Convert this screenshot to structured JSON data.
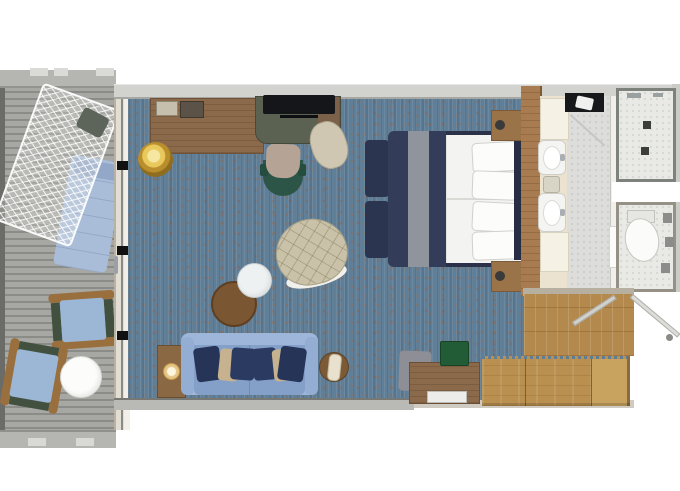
{
  "meta": {
    "type": "floor-plan",
    "subject": "cruise-ship balcony suite stateroom, top-down 3D floor plan",
    "width_px": 680,
    "height_px": 491
  },
  "palette": {
    "carpet_blue": "#5f7e97",
    "carpet_speckle_rust": "#96644082",
    "deck_gray": "#9d9d99",
    "oak_wood": "#b3894d",
    "walnut_wood": "#8b6a4b",
    "sofa_blue": "#84a0c9",
    "pillow_navy": "#263457",
    "pillow_tan": "#c6b28e",
    "bed_runner_navy": "#333c58",
    "bed_runner_gray": "#8f949d",
    "bed_frame_navy": "#2a3148",
    "gold_pouf": "#d8ac3f",
    "desk_chair_green": "#2d5547",
    "armchair_beige": "#c9c2a8",
    "bathroom_tile": "#dddddb",
    "vanity_cream": "#ebe3cf",
    "bath_mat_black": "#17181a",
    "lounger_blue": "#a9bdd9",
    "wall_gray": "#d2d2ce",
    "white": "#ffffff"
  },
  "rooms": [
    {
      "id": "balcony",
      "label": "Balcony"
    },
    {
      "id": "living-area",
      "label": "Living Area"
    },
    {
      "id": "bedroom",
      "label": "Bedroom"
    },
    {
      "id": "bathroom",
      "label": "Bathroom"
    },
    {
      "id": "shower-room",
      "label": "Shower Room"
    },
    {
      "id": "toilet-room",
      "label": "Toilet Room"
    },
    {
      "id": "entry-hall",
      "label": "Entry Hall"
    },
    {
      "id": "wardrobe",
      "label": "Wardrobe"
    }
  ],
  "furniture": {
    "balcony": [
      "Hammock lounger with net canopy",
      "Sun lounger with blue cushion",
      "Deck armchair (upper)",
      "Deck armchair (lower)",
      "Round white side table"
    ],
    "living": [
      "Writing desk",
      "Desk chair",
      "TV console",
      "Flat-screen TV",
      "Gold pouf",
      "Cream ottoman",
      "Quilted armchair",
      "White nesting table",
      "Brown nesting table",
      "Two-seat sofa",
      "Left end table with lamp",
      "Right round end table with lamp"
    ],
    "bedroom": [
      "King bed with white duvet",
      "Navy and gray bed runner",
      "Four pillows",
      "Foot bench",
      "Upper nightstand",
      "Lower nightstand",
      "Dresser with tray",
      "Gray luggage stool",
      "Green storage box"
    ],
    "bathroom": [
      "Double vanity counter",
      "Upper washbasin",
      "Lower washbasin",
      "Black bath mat with towel",
      "Glass shower enclosure",
      "Toilet"
    ],
    "entry": [
      "Entry door (swing)",
      "Bathroom door (swing)",
      "Built-in wardrobe",
      "Oak entry floor"
    ]
  },
  "doors": [
    "Balcony sliding glass door",
    "Bathroom door",
    "Shower glass door",
    "Toilet compartment door",
    "Cabin entry door"
  ]
}
